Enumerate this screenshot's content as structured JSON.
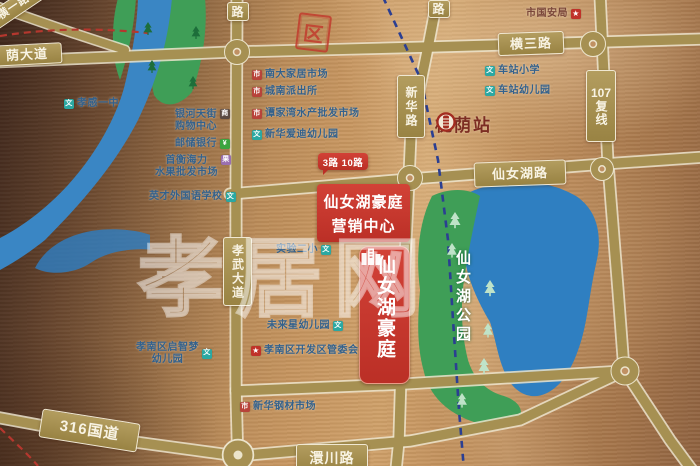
{
  "map": {
    "watermark": "孝居网",
    "stamp": "区",
    "station": {
      "name": "槐荫站"
    },
    "park": {
      "name": "仙女湖公园"
    },
    "project": {
      "badge": "仙女湖豪庭",
      "sales_line1": "仙女湖豪庭",
      "sales_line2": "营销中心",
      "bus_routes": "3路 10路"
    },
    "road_plates": {
      "heng_yi": "横一路",
      "yin_da_dao": "荫大道",
      "lu_top_left": "路",
      "lu_top_right": "路",
      "heng_san": "横三路",
      "xin_hua": "新华路",
      "g107_num": "107",
      "g107_suffix": "复线",
      "xian_nv_hu": "仙女湖路",
      "xiao_wu": "孝武大道",
      "g316": "316国道",
      "huan_chuan": "澴川路"
    },
    "pois": [
      {
        "id": "guo-an-ju",
        "label": "市国安局",
        "icon": "star"
      },
      {
        "id": "xiaogan-yizhong",
        "label": "孝感一中",
        "icon": "school"
      },
      {
        "id": "yinhe-tianjie",
        "label": "银河天街",
        "label2": "购物中心",
        "icon": "mall"
      },
      {
        "id": "youchu-bank",
        "label": "邮储银行",
        "icon": "bank"
      },
      {
        "id": "shuiguo-market",
        "label": "首衡海力",
        "label2": "水果批发市场",
        "icon": "fruit"
      },
      {
        "id": "yingcai-school",
        "label": "英才外国语学校",
        "icon": "school"
      },
      {
        "id": "nanda-market",
        "label": "南大家居市场",
        "icon": "market"
      },
      {
        "id": "chengnan-paichusuo",
        "label": "城南派出所",
        "icon": "market"
      },
      {
        "id": "shuichan-market",
        "label": "谭家湾水产批发市场",
        "icon": "market"
      },
      {
        "id": "xinhua-kindergarten",
        "label": "新华爱迪幼儿园",
        "icon": "school"
      },
      {
        "id": "chezhan-primary",
        "label": "车站小学",
        "icon": "school"
      },
      {
        "id": "chezhan-kindergarten",
        "label": "车站幼儿园",
        "icon": "school"
      },
      {
        "id": "shiyan-erxiao",
        "label": "实验二小",
        "icon": "school"
      },
      {
        "id": "weilaixing-kindergarten",
        "label": "未来星幼儿园",
        "icon": "school"
      },
      {
        "id": "qizhimeng-kindergarten",
        "label": "孝南区启智梦",
        "label2": "幼儿园",
        "icon": "school"
      },
      {
        "id": "guanweihui",
        "label": "孝南区开发区管委会",
        "icon": "star"
      },
      {
        "id": "xinhua-steel-market",
        "label": "新华钢材市场",
        "icon": "market"
      }
    ],
    "colors": {
      "copper_bg": "#c6955f",
      "road": "#a69052",
      "road_edge": "#ece4cc",
      "lake": "#2f7fc1",
      "park": "#3f9e57",
      "river": "#3a86c4",
      "badge_red": "#c9352b",
      "rail_dash_blue": "#2b3f92",
      "boundary_dash_red": "#b5372e",
      "poi_text": "#33618c",
      "station_text": "#7c2d22"
    }
  }
}
